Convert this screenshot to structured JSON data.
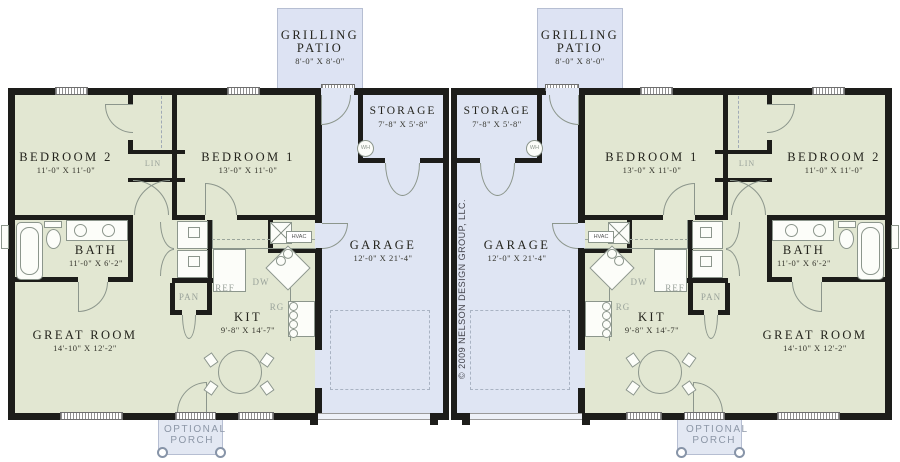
{
  "plan": {
    "copyright": "© 2009 NELSON DESIGN GROUP, LLC.",
    "rooms": {
      "grilling_patio": {
        "name": "GRILLING PATIO",
        "dims": "8'-0\" X 8'-0\""
      },
      "storage": {
        "name": "STORAGE",
        "dims": "7'-8\" X 5'-8\""
      },
      "garage": {
        "name": "GARAGE",
        "dims": "12'-0\" X 21'-4\""
      },
      "bedroom_1": {
        "name": "BEDROOM 1",
        "dims": "13'-0\" X 11'-0\""
      },
      "bedroom_2": {
        "name": "BEDROOM 2",
        "dims": "11'-0\" X 11'-0\""
      },
      "bath": {
        "name": "BATH",
        "dims": "11'-0\" X 6'-2\""
      },
      "great_room": {
        "name": "GREAT ROOM",
        "dims": "14'-10\" X 12'-2\""
      },
      "kitchen": {
        "name": "KIT",
        "dims": "9'-8\" X 14'-7\""
      },
      "optional_porch": {
        "line1": "OPTIONAL",
        "line2": "PORCH"
      }
    },
    "fixture_labels": {
      "lin": "LIN",
      "pan": "PAN",
      "ref": "REF",
      "dw": "DW",
      "rg": "RG",
      "hvac": "HVAC",
      "wh": "WH"
    },
    "colors": {
      "living": "#e2e7d2",
      "garage": "#dfe5f3",
      "patio": "#dde3f3",
      "porch": "#e3e8f3",
      "wall": "#1d1d1a"
    }
  }
}
